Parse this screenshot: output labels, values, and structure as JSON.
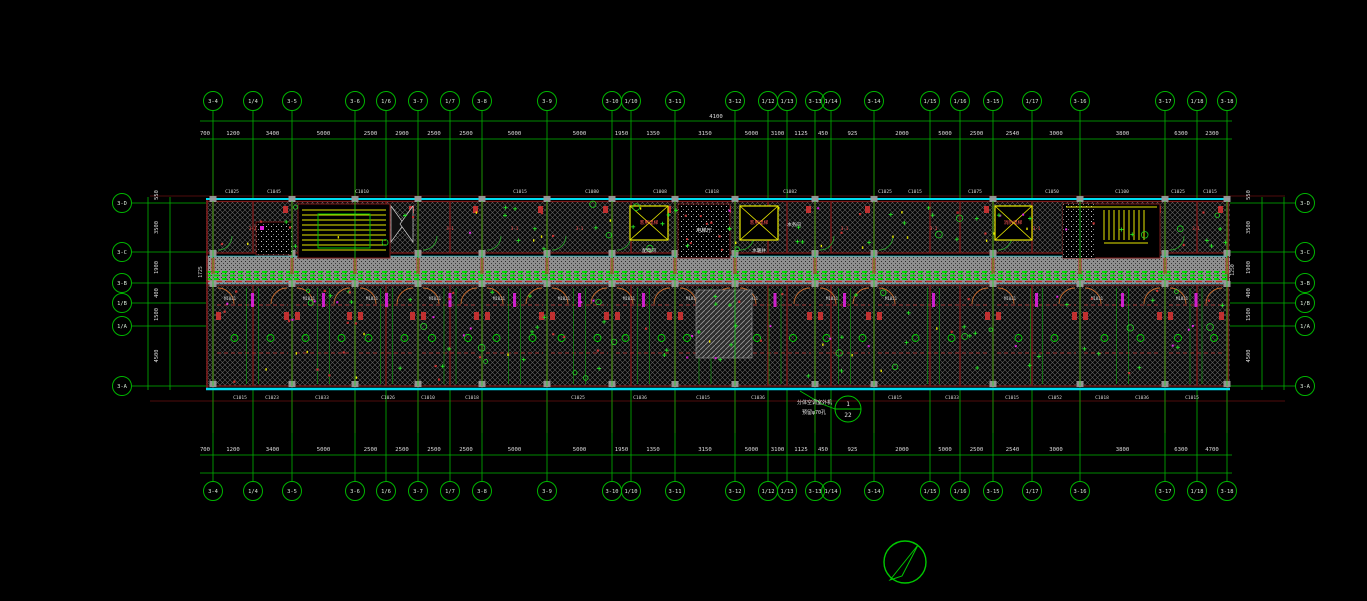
{
  "drawing": {
    "colors": {
      "grid_green": "#00b400",
      "bright_green": "#18d818",
      "dim_text": "#dcdcdc",
      "cyan": "#00dcf0",
      "yellow": "#e8e800",
      "maroon": "#7c1a1a",
      "column_red": "#8b1515",
      "red": "#c03030",
      "magenta": "#e020e0",
      "gray": "#9a9a9a",
      "door_orange": "#cd6a2a",
      "label_red": "#ff5555",
      "white": "#e8e8e8"
    },
    "axes_top": [
      {
        "x": 213,
        "label": "3-4"
      },
      {
        "x": 253,
        "label": "1/4"
      },
      {
        "x": 292,
        "label": "3-5"
      },
      {
        "x": 355,
        "label": "3-6"
      },
      {
        "x": 386,
        "label": "1/6"
      },
      {
        "x": 418,
        "label": "3-7"
      },
      {
        "x": 450,
        "label": "1/7"
      },
      {
        "x": 482,
        "label": "3-8"
      },
      {
        "x": 547,
        "label": "3-9"
      },
      {
        "x": 612,
        "label": "3-10"
      },
      {
        "x": 631,
        "label": "1/10"
      },
      {
        "x": 675,
        "label": "3-11"
      },
      {
        "x": 735,
        "label": "3-12"
      },
      {
        "x": 768,
        "label": "1/12"
      },
      {
        "x": 787,
        "label": "1/13"
      },
      {
        "x": 815,
        "label": "3-13"
      },
      {
        "x": 831,
        "label": "1/14"
      },
      {
        "x": 874,
        "label": "3-14"
      },
      {
        "x": 930,
        "label": "1/15"
      },
      {
        "x": 960,
        "label": "1/16"
      },
      {
        "x": 993,
        "label": "3-15"
      },
      {
        "x": 1032,
        "label": "1/17"
      },
      {
        "x": 1080,
        "label": "3-16"
      },
      {
        "x": 1165,
        "label": "3-17"
      },
      {
        "x": 1197,
        "label": "1/18"
      },
      {
        "x": 1227,
        "label": "3-18"
      }
    ],
    "dims_top": [
      "1200",
      "3400",
      "5000",
      "2500",
      "2900",
      "2500",
      "2500",
      "5000",
      "5000",
      "1950",
      "1350",
      "3150",
      "5000",
      "3100",
      "1125",
      "450",
      "925",
      "2000",
      "5000",
      "2500",
      "2540",
      "3000",
      "3800",
      "6300",
      "2300"
    ],
    "dim_top_leading": "700",
    "dim_top_total": "4100",
    "axes_bottom": [
      {
        "x": 213,
        "label": "3-4"
      },
      {
        "x": 253,
        "label": "1/4"
      },
      {
        "x": 292,
        "label": "3-5"
      },
      {
        "x": 355,
        "label": "3-6"
      },
      {
        "x": 386,
        "label": "1/6"
      },
      {
        "x": 418,
        "label": "3-7"
      },
      {
        "x": 450,
        "label": "1/7"
      },
      {
        "x": 482,
        "label": "3-8"
      },
      {
        "x": 547,
        "label": "3-9"
      },
      {
        "x": 612,
        "label": "3-10"
      },
      {
        "x": 631,
        "label": "1/10"
      },
      {
        "x": 675,
        "label": "3-11"
      },
      {
        "x": 735,
        "label": "3-12"
      },
      {
        "x": 768,
        "label": "1/12"
      },
      {
        "x": 787,
        "label": "1/13"
      },
      {
        "x": 815,
        "label": "3-13"
      },
      {
        "x": 831,
        "label": "1/14"
      },
      {
        "x": 874,
        "label": "3-14"
      },
      {
        "x": 930,
        "label": "1/15"
      },
      {
        "x": 960,
        "label": "1/16"
      },
      {
        "x": 993,
        "label": "3-15"
      },
      {
        "x": 1032,
        "label": "1/17"
      },
      {
        "x": 1080,
        "label": "3-16"
      },
      {
        "x": 1165,
        "label": "3-17"
      },
      {
        "x": 1197,
        "label": "1/18"
      },
      {
        "x": 1227,
        "label": "3-18"
      }
    ],
    "dims_bottom": [
      "1200",
      "3400",
      "5000",
      "2500",
      "2500",
      "2500",
      "2500",
      "5000",
      "5000",
      "1950",
      "1350",
      "3150",
      "5000",
      "3100",
      "1125",
      "450",
      "925",
      "2000",
      "5000",
      "2500",
      "2540",
      "3000",
      "3800",
      "6300",
      "4700"
    ],
    "dim_bottom_leading": "700",
    "axes_left": [
      {
        "y": 203,
        "label": "3-D"
      },
      {
        "y": 252,
        "label": "3-C"
      },
      {
        "y": 283,
        "label": "3-B"
      },
      {
        "y": 303,
        "label": "1/B"
      },
      {
        "y": 326,
        "label": "1/A"
      },
      {
        "y": 386,
        "label": "3-A"
      }
    ],
    "dims_left": [
      "3500",
      "1900",
      "400",
      "1500",
      "4500"
    ],
    "dim_left_leading": "550",
    "axes_right": [
      {
        "y": 203,
        "label": "3-D"
      },
      {
        "y": 252,
        "label": "3-C"
      },
      {
        "y": 283,
        "label": "3-B"
      },
      {
        "y": 303,
        "label": "1/B"
      },
      {
        "y": 326,
        "label": "1/A"
      },
      {
        "y": 386,
        "label": "3-A"
      }
    ],
    "dims_right": [
      "3500",
      "1900",
      "400",
      "1500",
      "4500"
    ],
    "dim_right_leading": "550",
    "side_note_left": "1725",
    "side_note_right": "1250",
    "wall_tags_top": [
      {
        "t": "C1025",
        "x": 232
      },
      {
        "t": "C1045",
        "x": 274
      },
      {
        "t": "C1010",
        "x": 362
      },
      {
        "t": "C1015",
        "x": 520
      },
      {
        "t": "C1080",
        "x": 592
      },
      {
        "t": "C1008",
        "x": 660
      },
      {
        "t": "C1018",
        "x": 712
      },
      {
        "t": "C1082",
        "x": 790
      },
      {
        "t": "C1025",
        "x": 885
      },
      {
        "t": "C1015",
        "x": 915
      },
      {
        "t": "C1075",
        "x": 975
      },
      {
        "t": "C1050",
        "x": 1052
      },
      {
        "t": "C1100",
        "x": 1122
      },
      {
        "t": "C1025",
        "x": 1178
      },
      {
        "t": "C1015",
        "x": 1210
      }
    ],
    "wall_tags_bottom": [
      {
        "t": "C1015",
        "x": 240
      },
      {
        "t": "C1023",
        "x": 272
      },
      {
        "t": "C1033",
        "x": 322
      },
      {
        "t": "C1026",
        "x": 388
      },
      {
        "t": "C1010",
        "x": 428
      },
      {
        "t": "C1018",
        "x": 472
      },
      {
        "t": "C1025",
        "x": 578
      },
      {
        "t": "C1036",
        "x": 640
      },
      {
        "t": "C1015",
        "x": 703
      },
      {
        "t": "C1036",
        "x": 758
      },
      {
        "t": "C1015",
        "x": 895
      },
      {
        "t": "C1033",
        "x": 952
      },
      {
        "t": "C1015",
        "x": 1012
      },
      {
        "t": "C1052",
        "x": 1055
      },
      {
        "t": "C1018",
        "x": 1102
      },
      {
        "t": "C1036",
        "x": 1142
      },
      {
        "t": "C1015",
        "x": 1192
      }
    ],
    "room_labels": [
      {
        "t": "客用电梯",
        "x": 649,
        "y": 224,
        "c": "#ff5555",
        "s": 4.6
      },
      {
        "t": "客用电梯",
        "x": 759,
        "y": 224,
        "c": "#ff5555",
        "s": 4.6
      },
      {
        "t": "电梯厅",
        "x": 704,
        "y": 232,
        "c": "#e8e8e8",
        "s": 5.2
      },
      {
        "t": "配电间",
        "x": 649,
        "y": 252,
        "c": "#e8e8e8",
        "s": 4.6
      },
      {
        "t": "水暖井",
        "x": 759,
        "y": 252,
        "c": "#e8e8e8",
        "s": 4.6
      },
      {
        "t": "水务间",
        "x": 794,
        "y": 226,
        "c": "#e8e8e8",
        "s": 4.6
      },
      {
        "t": "消防电梯",
        "x": 1013,
        "y": 224,
        "c": "#ff5555",
        "s": 4.6
      }
    ],
    "top_module_ref": "3-1",
    "bottom_module_tag": "M1021",
    "callout": {
      "num_top": "1",
      "num_bottom": "22",
      "note1": "分体空调室外机",
      "note2": "预留φ70孔"
    }
  }
}
